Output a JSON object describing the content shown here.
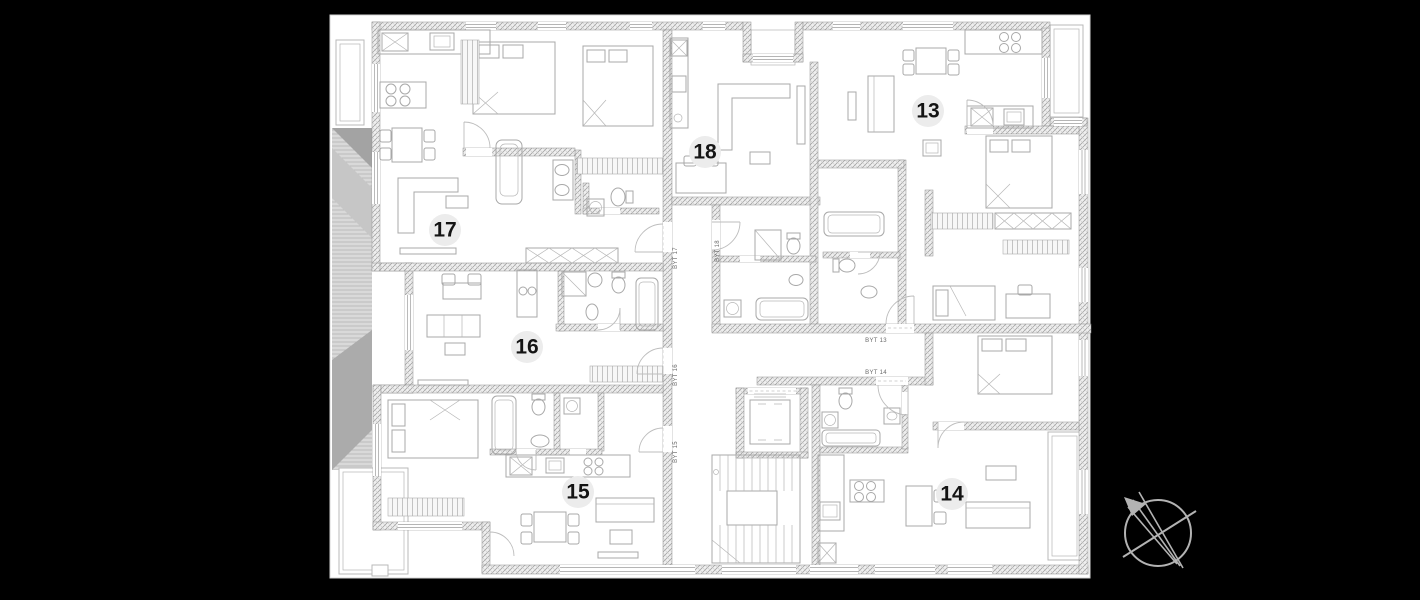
{
  "scene": {
    "background": "#000000",
    "canvas": {
      "x": 330,
      "y": 15,
      "w": 760,
      "h": 563,
      "fill": "#ffffff",
      "border": "#d4d4d4"
    }
  },
  "floorplan": {
    "badge_style": {
      "fill": "#ececec",
      "text_color": "#141414",
      "radius": 16,
      "font_size": 21
    },
    "unit_badges": [
      {
        "number": "13",
        "x": 928,
        "y": 111
      },
      {
        "number": "14",
        "x": 952,
        "y": 494
      },
      {
        "number": "15",
        "x": 578,
        "y": 492
      },
      {
        "number": "16",
        "x": 527,
        "y": 347
      },
      {
        "number": "17",
        "x": 445,
        "y": 230
      },
      {
        "number": "18",
        "x": 705,
        "y": 152
      }
    ],
    "label_style": {
      "color": "#6a6a6a",
      "font_size": 6
    },
    "apartment_labels": [
      {
        "text": "BYT 17",
        "x": 677,
        "y": 258,
        "vertical": true
      },
      {
        "text": "BYT 18",
        "x": 719,
        "y": 251,
        "vertical": true
      },
      {
        "text": "BYT 16",
        "x": 677,
        "y": 375,
        "vertical": true
      },
      {
        "text": "BYT 15",
        "x": 677,
        "y": 452,
        "vertical": true
      },
      {
        "text": "BYT 13",
        "x": 876,
        "y": 342,
        "vertical": false
      },
      {
        "text": "BYT 14",
        "x": 876,
        "y": 374,
        "vertical": false
      }
    ]
  },
  "compass": {
    "cx": 1158,
    "cy": 533,
    "r": 33,
    "color": "#b3b3b3"
  }
}
